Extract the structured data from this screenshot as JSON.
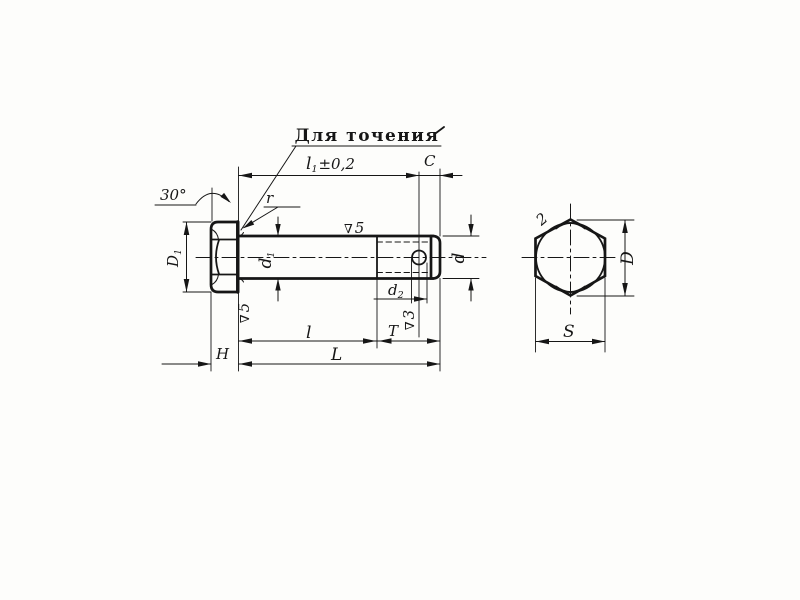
{
  "title": {
    "text": "Для точения"
  },
  "dimensions": {
    "angle30": "30°",
    "l1": {
      "base": "l",
      "sub": "1",
      "tol": "±0,2"
    },
    "C": "C",
    "r": "r",
    "D1": {
      "base": "D",
      "sub": "1"
    },
    "d1": {
      "base": "d",
      "sub": "1"
    },
    "d": "d",
    "d2": {
      "base": "d",
      "sub": "2"
    },
    "l": "l",
    "T": "T",
    "L": "L",
    "H": "H",
    "D": "D",
    "S": "S",
    "chamfer_note": "2"
  },
  "surface_finish": {
    "shank": {
      "symbol": "∇",
      "value": "5"
    },
    "head_face": {
      "symbol": "∇",
      "value": "5"
    },
    "thread": {
      "symbol": "∇",
      "value": "3"
    }
  }
}
